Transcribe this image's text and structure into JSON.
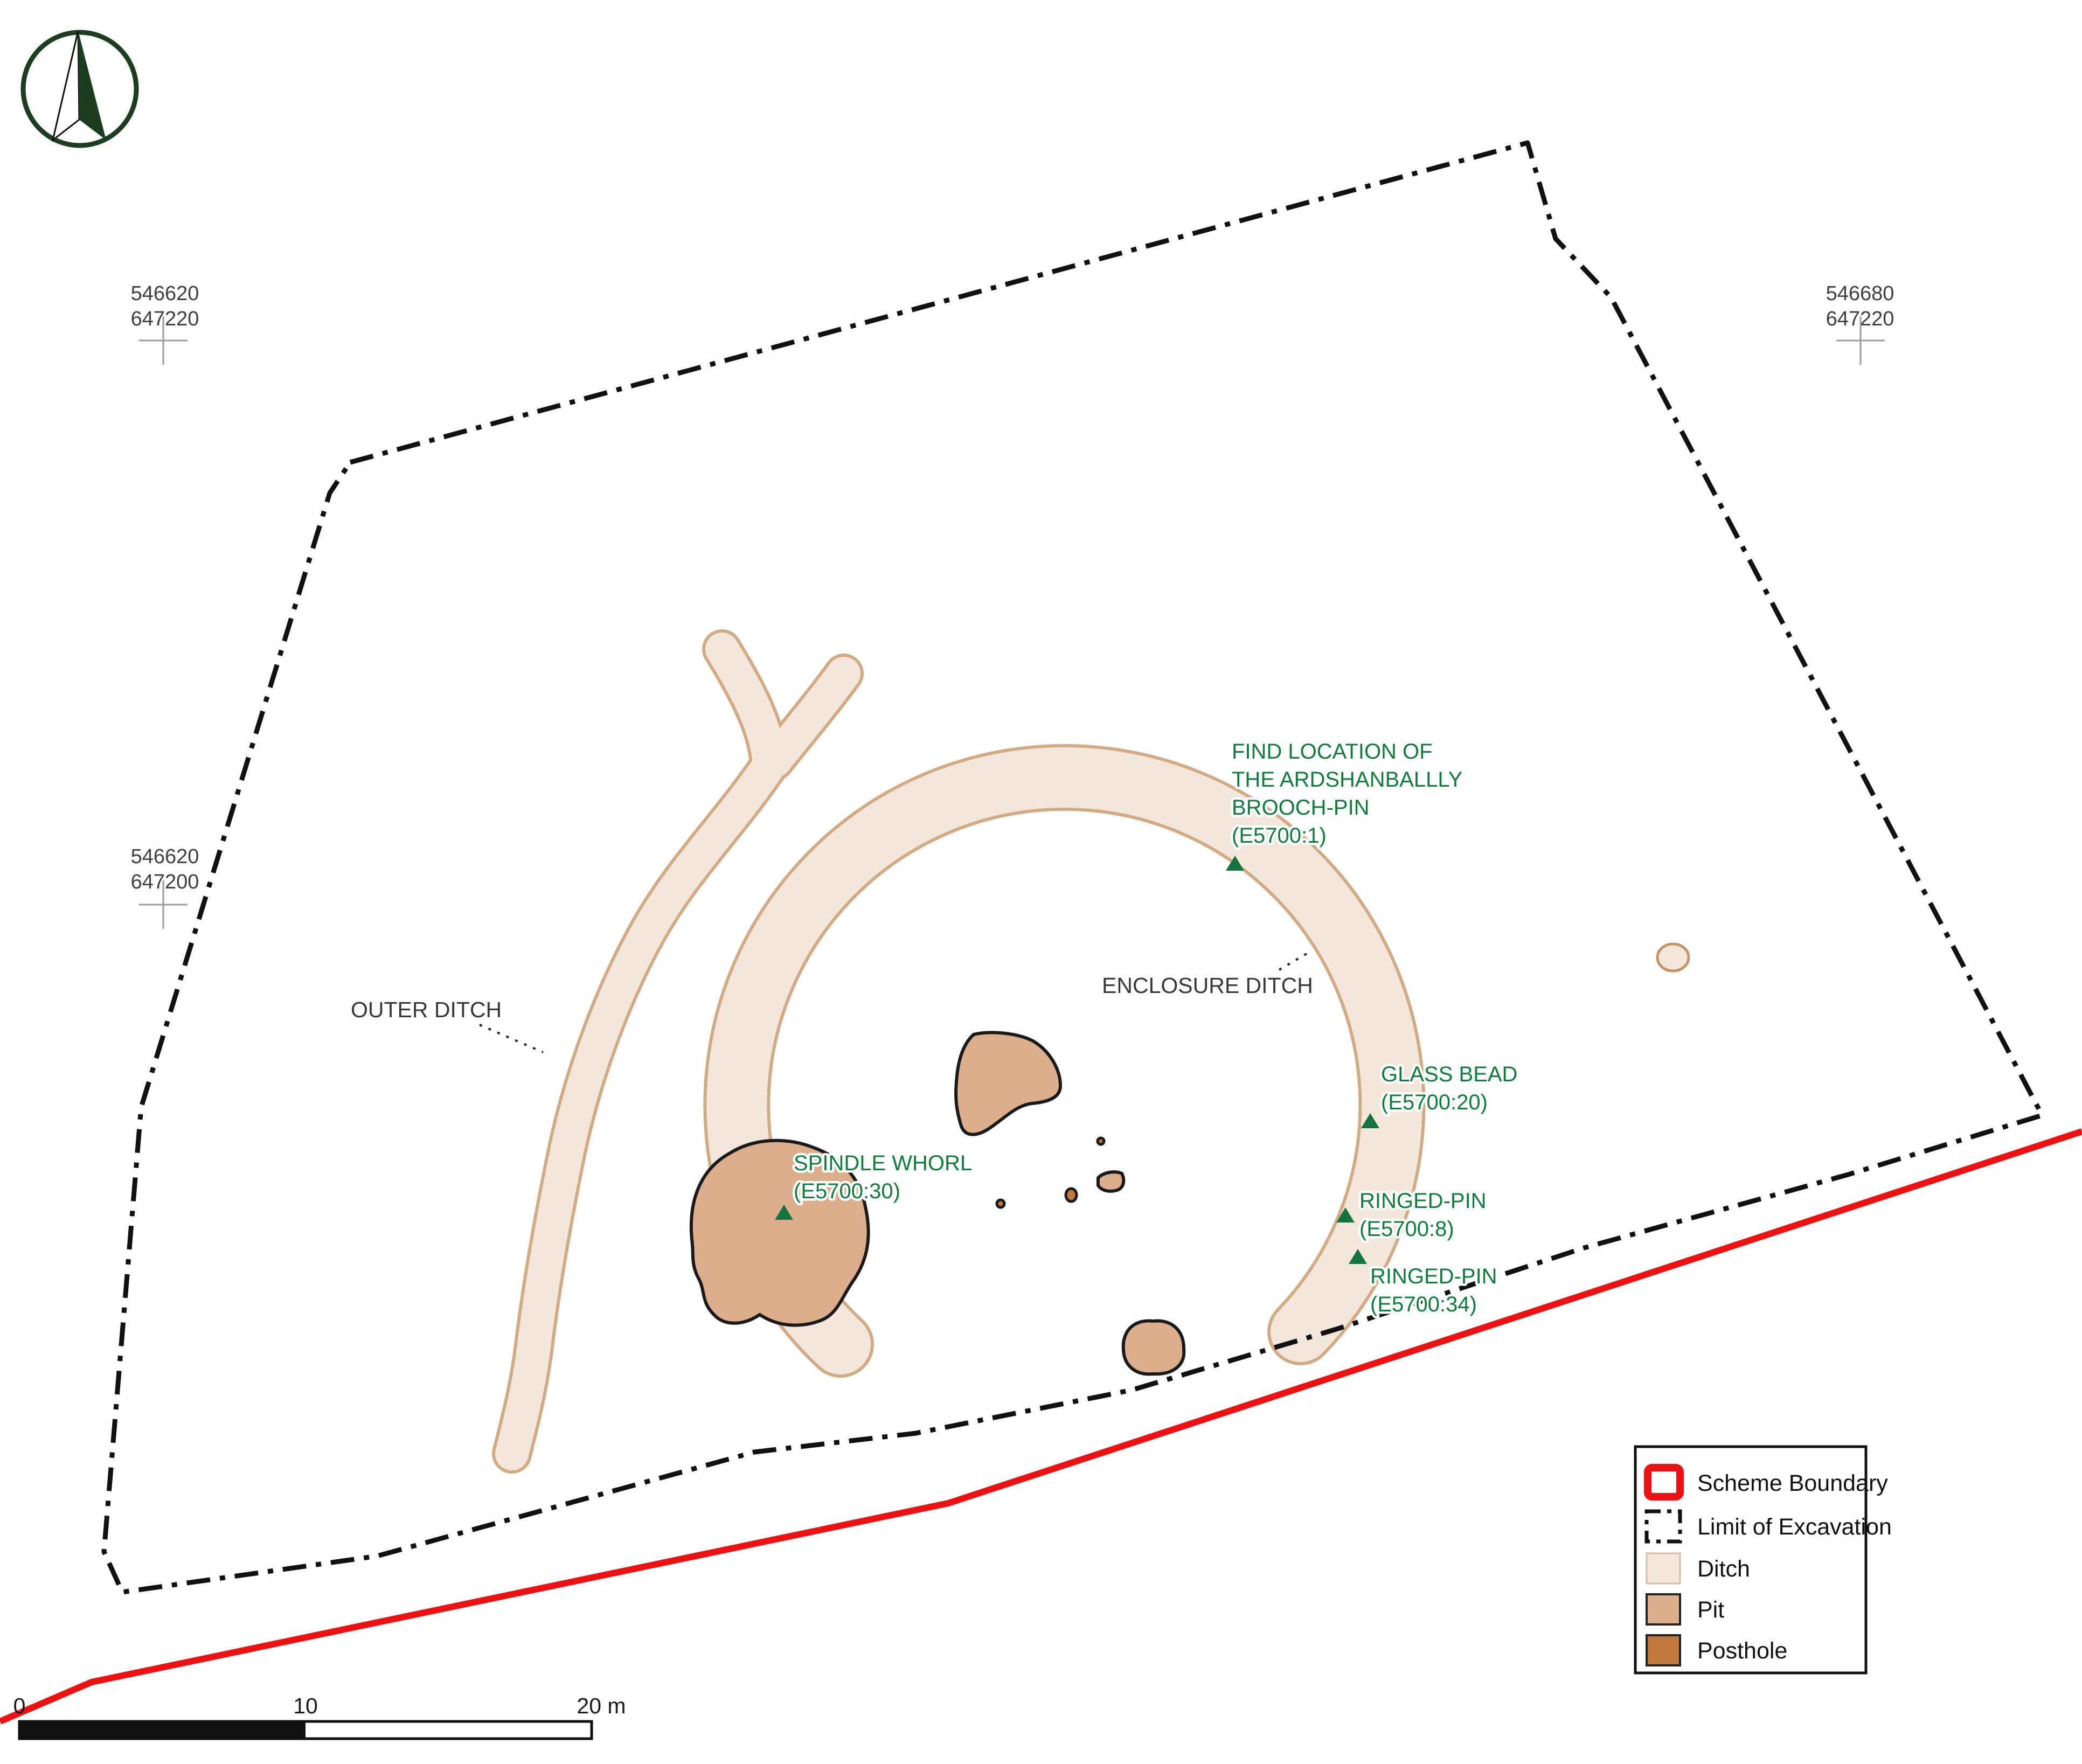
{
  "map_type": "archaeological excavation plan",
  "colors": {
    "scheme_boundary_red": "#ee1111",
    "excavation_limit_black": "#111111",
    "ditch_fill": "#f3e7db",
    "ditch_edge": "#d2ab84",
    "pit_fill": "#dcae8b",
    "posthole_fill": "#c1783c",
    "find_green": "#0e7d3c",
    "north_arrow_green": "#1d3d1f",
    "label_gray": "#383838"
  },
  "grid_references": [
    {
      "easting": "546620",
      "northing": "647220"
    },
    {
      "easting": "546680",
      "northing": "647220"
    },
    {
      "easting": "546620",
      "northing": "647200"
    }
  ],
  "feature_labels": [
    {
      "text": "OUTER DITCH"
    },
    {
      "text": "ENCLOSURE DITCH"
    }
  ],
  "finds": [
    {
      "lines": [
        "FIND LOCATION OF",
        "THE ARDSHANBALLLY",
        "BROOCH-PIN",
        "(E5700:1)"
      ]
    },
    {
      "lines": [
        "GLASS BEAD",
        "(E5700:20)"
      ]
    },
    {
      "lines": [
        "RINGED-PIN",
        "(E5700:8)"
      ]
    },
    {
      "lines": [
        "RINGED-PIN",
        "(E5700:34)"
      ]
    },
    {
      "lines": [
        "SPINDLE WHORL",
        "(E5700:30)"
      ]
    }
  ],
  "legend": {
    "items": [
      {
        "label": "Scheme Boundary",
        "swatch": "scheme-boundary"
      },
      {
        "label": "Limit of Excavation",
        "swatch": "limit-of-excavation"
      },
      {
        "label": "Ditch",
        "swatch": "ditch"
      },
      {
        "label": "Pit",
        "swatch": "pit"
      },
      {
        "label": "Posthole",
        "swatch": "posthole"
      }
    ]
  },
  "scale_bar": {
    "tick_labels": [
      "0",
      "10",
      "20 m"
    ]
  }
}
